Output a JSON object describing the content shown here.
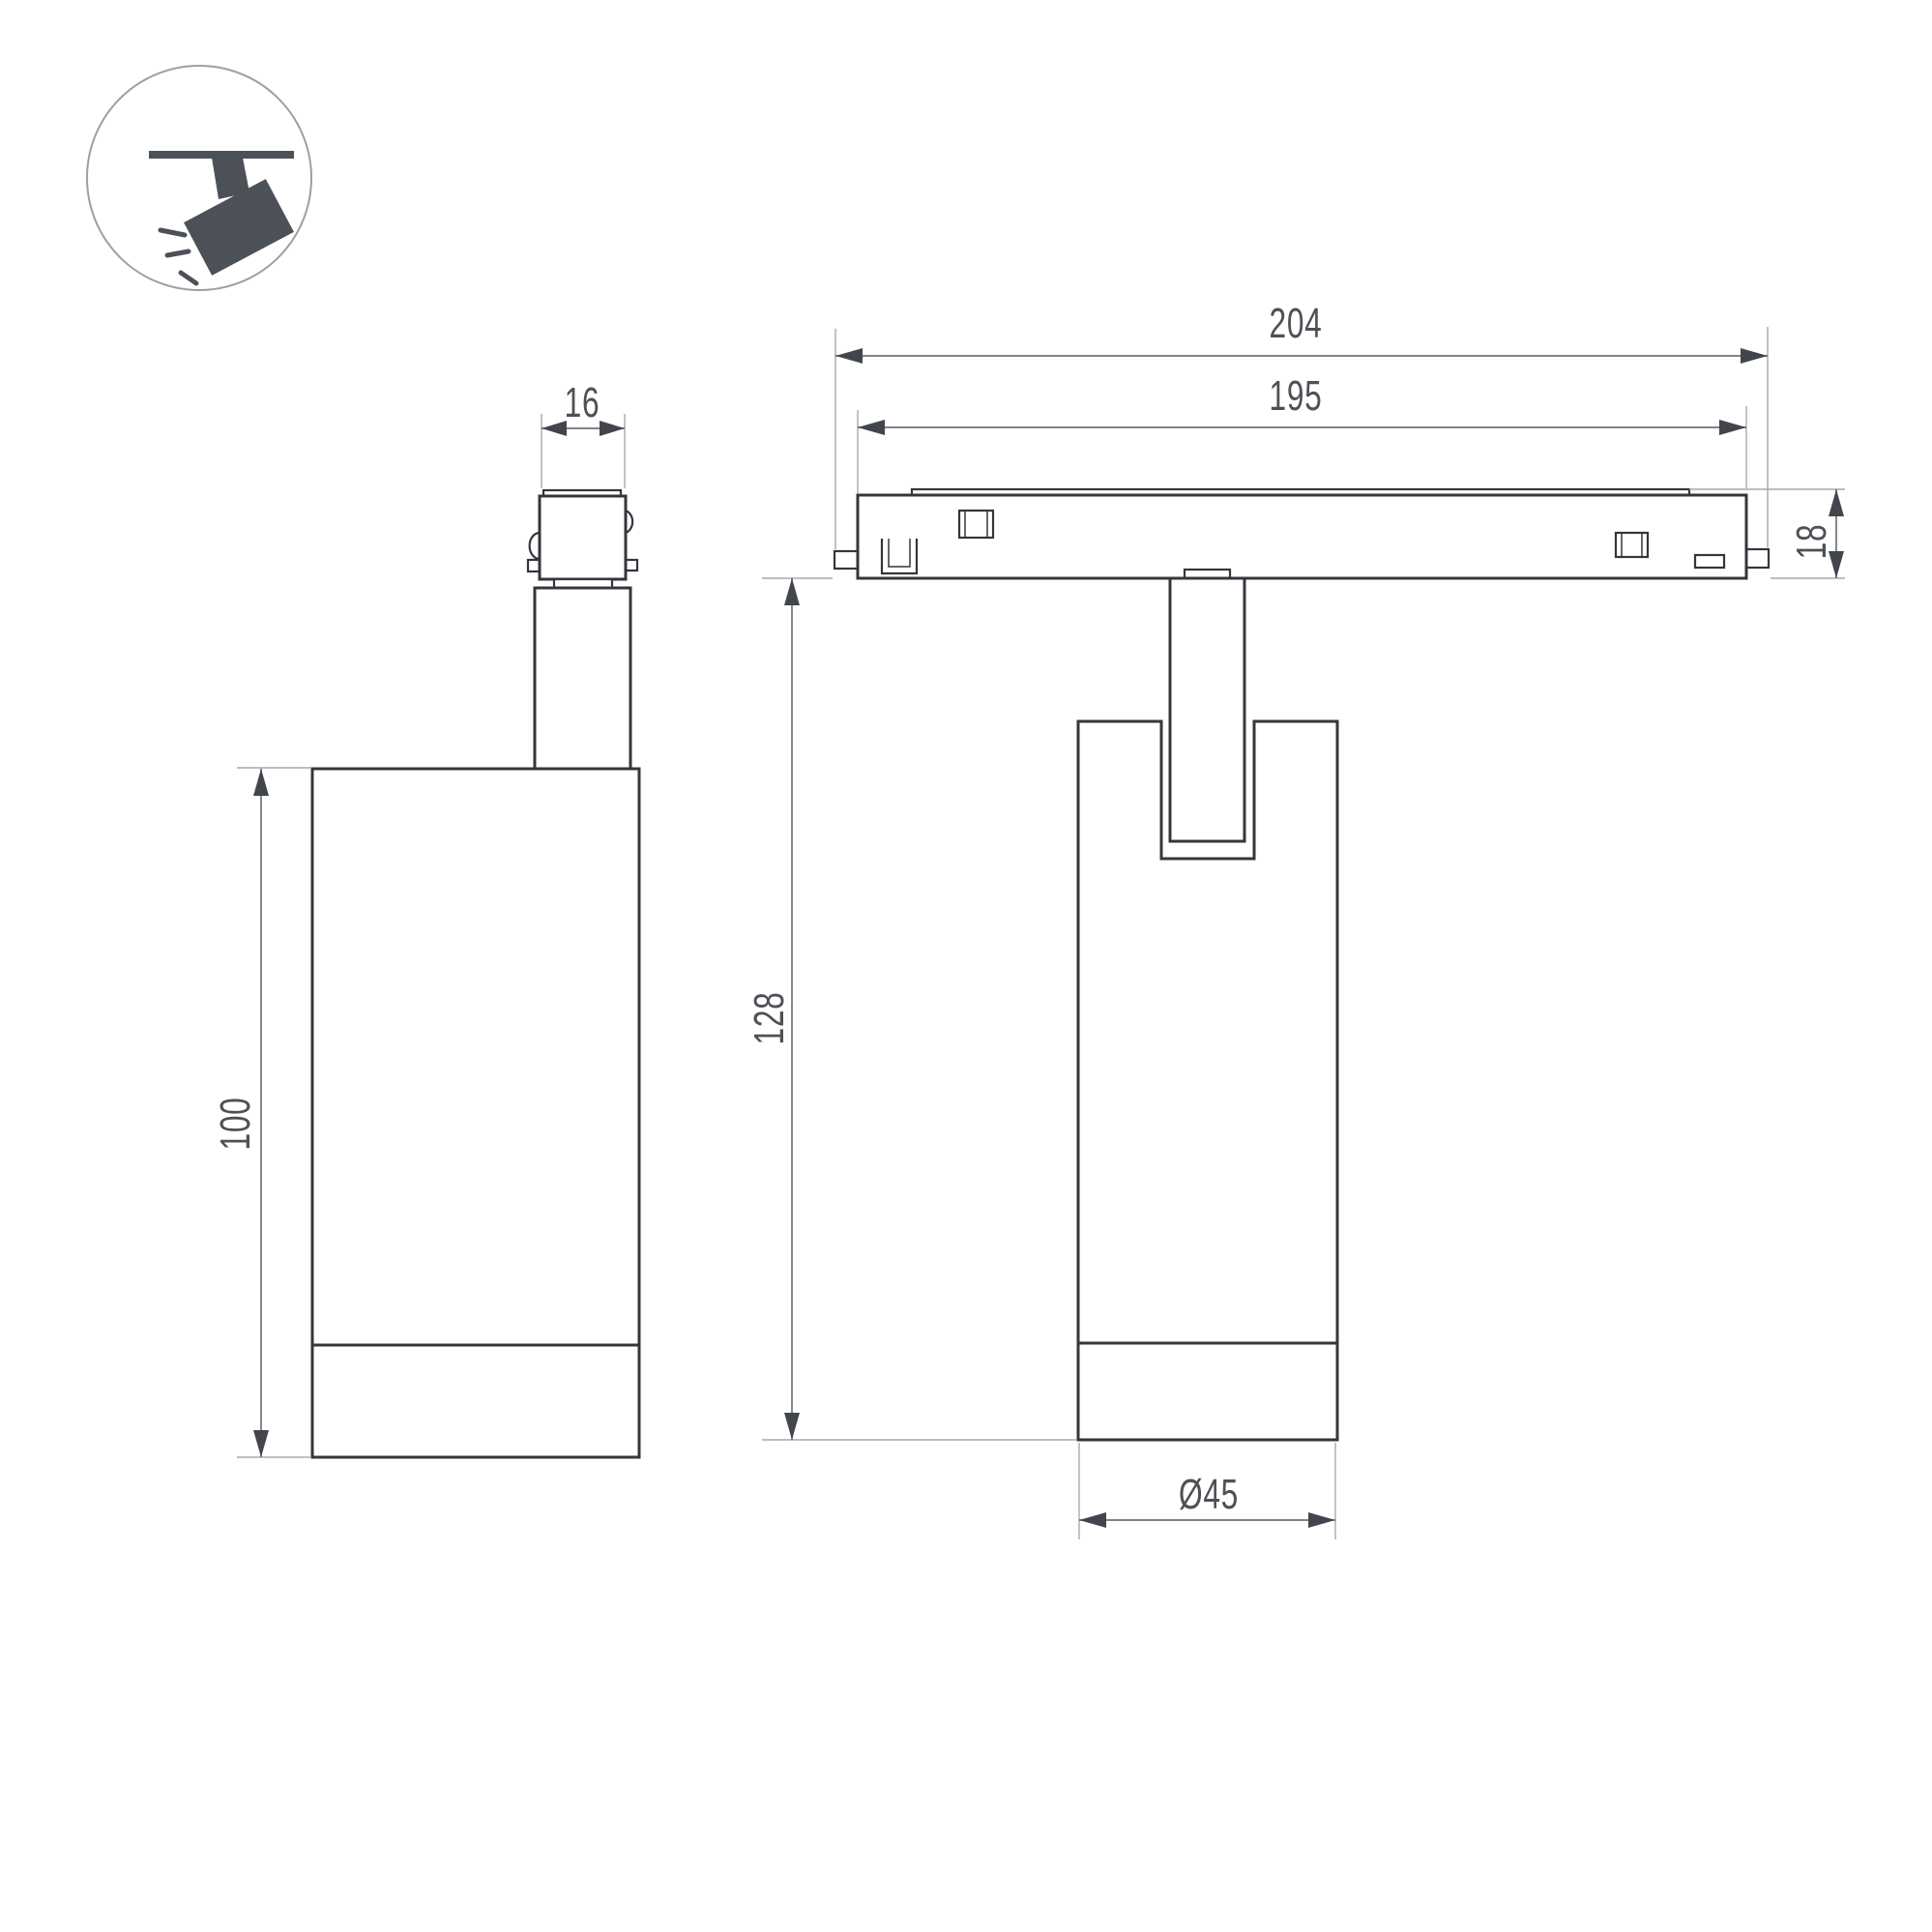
{
  "icon": {
    "label": "track-spotlight-pictogram"
  },
  "dimensions": {
    "connector_width": "16",
    "overall_track_length": "204",
    "track_length": "195",
    "track_height": "18",
    "body_length": "100",
    "overall_height": "128",
    "body_diameter": "Ø45"
  },
  "colors": {
    "background": "#ffffff",
    "line": "#33373c",
    "ext": "#a6a9ad",
    "dim": "#6e7277",
    "arrow": "#42464c",
    "text": "#4d5156",
    "icon": "#4b5157",
    "icon_ring": "#9ba0a4"
  }
}
